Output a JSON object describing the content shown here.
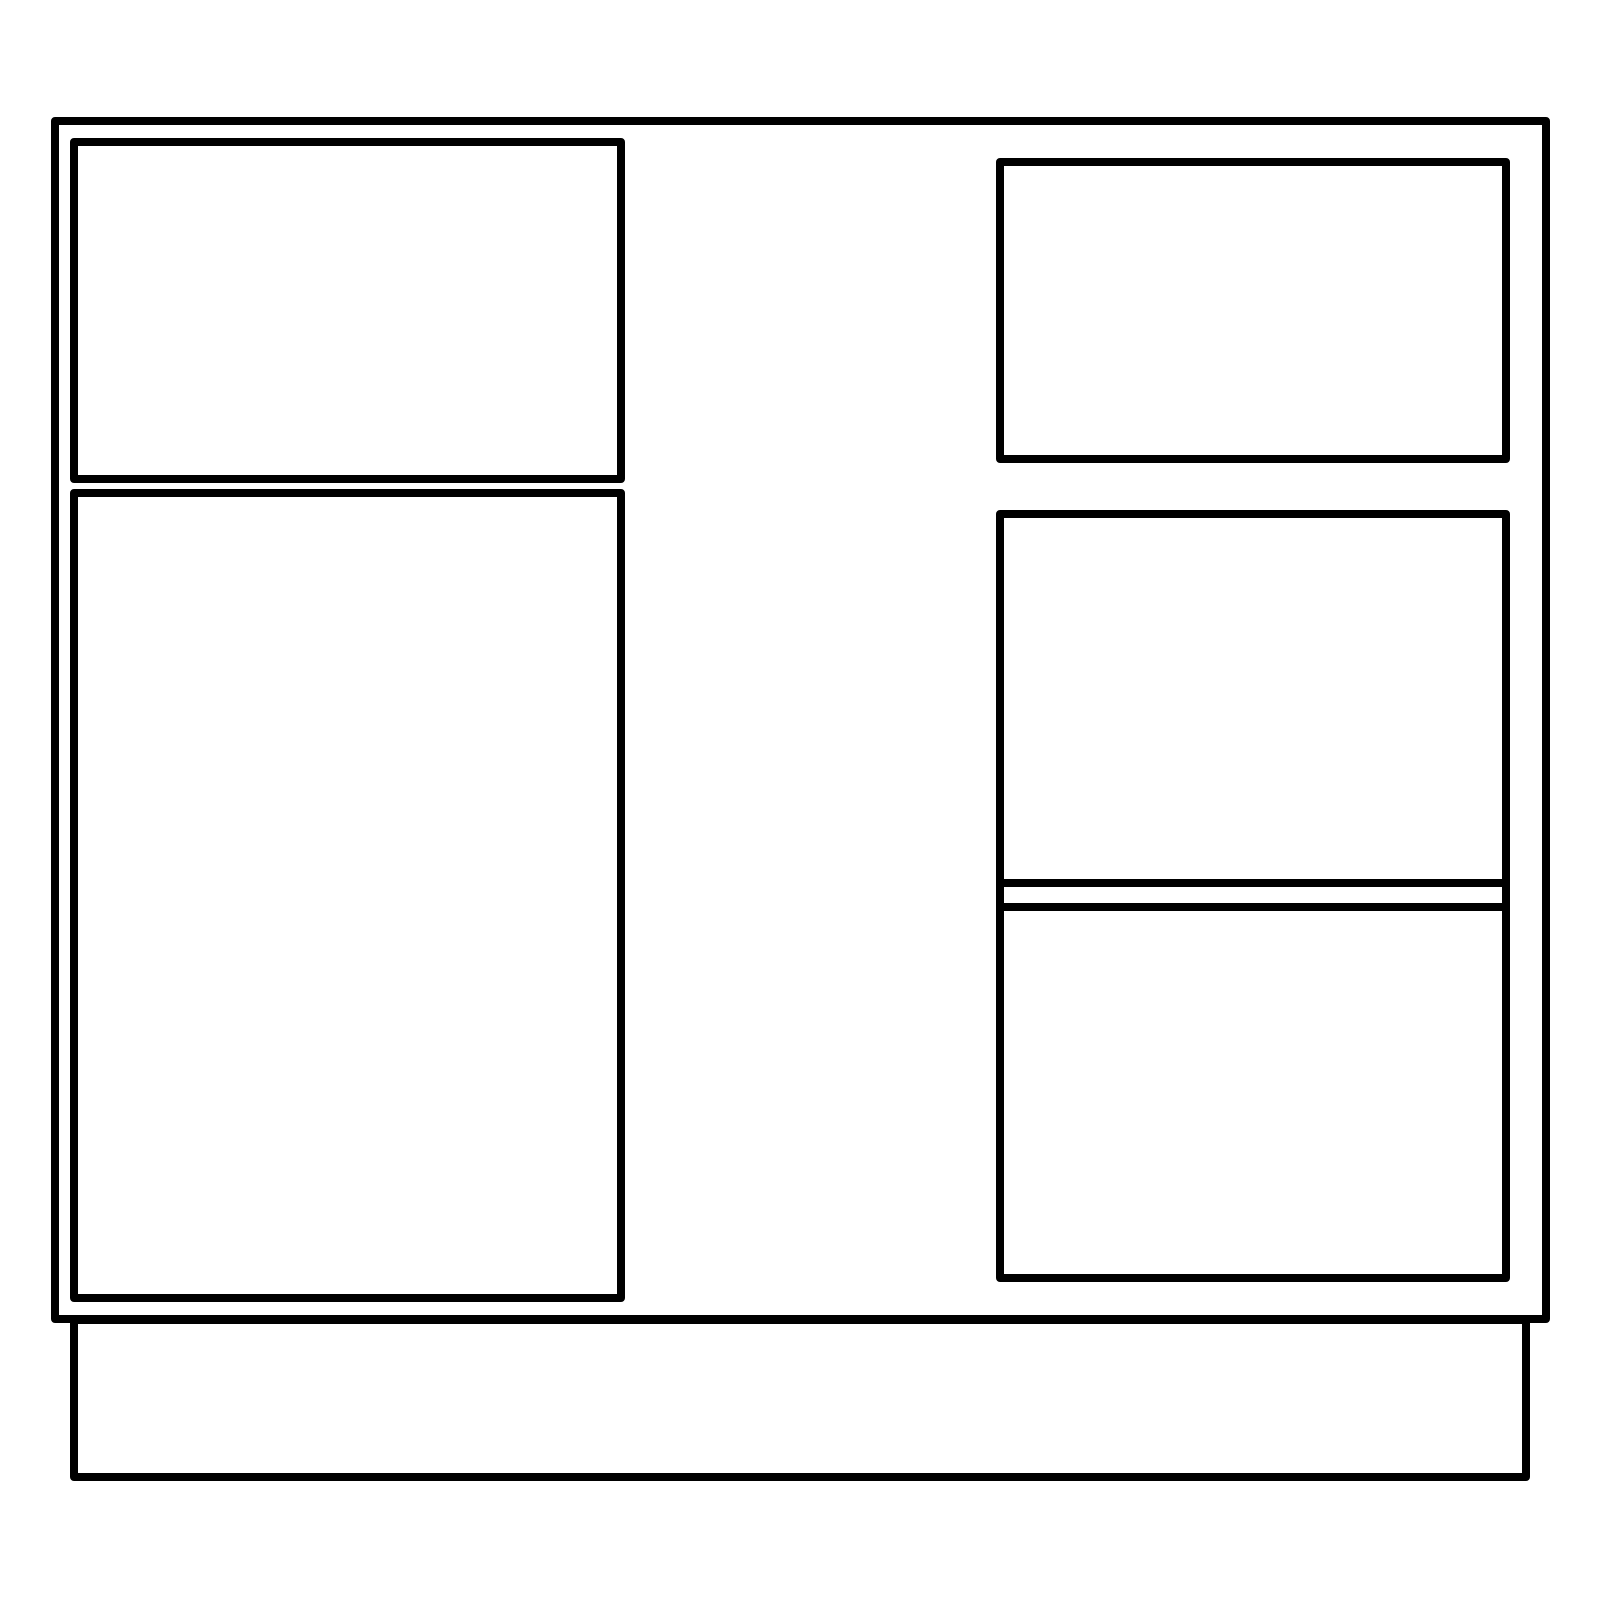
{
  "drawing": {
    "title": "cabinet-elevation-line-drawing",
    "canvas": {
      "width": 1600,
      "height": 1600,
      "background_color": "#ffffff"
    },
    "stroke_color": "#000000",
    "stroke_width": 8,
    "fill": "none",
    "shapes": [
      {
        "name": "cabinet-outline",
        "x": 51,
        "y": 117,
        "w": 1499,
        "h": 1206
      },
      {
        "name": "left-top-drawer-front",
        "x": 70,
        "y": 138,
        "w": 555,
        "h": 345
      },
      {
        "name": "left-door-panel",
        "x": 70,
        "y": 489,
        "w": 555,
        "h": 813
      },
      {
        "name": "right-top-drawer-front",
        "x": 996,
        "y": 158,
        "w": 514,
        "h": 305
      },
      {
        "name": "right-middle-panel",
        "x": 996,
        "y": 510,
        "w": 514,
        "h": 377
      },
      {
        "name": "right-divider-rail",
        "x": 996,
        "y": 879,
        "w": 514,
        "h": 32
      },
      {
        "name": "right-bottom-panel",
        "x": 996,
        "y": 903,
        "w": 514,
        "h": 379
      },
      {
        "name": "base-plinth",
        "x": 70,
        "y": 1316,
        "w": 1460,
        "h": 165
      }
    ]
  }
}
